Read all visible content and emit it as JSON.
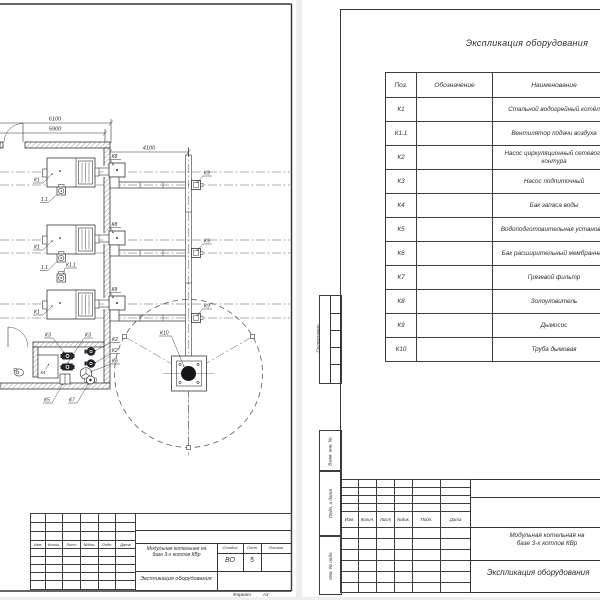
{
  "plan_sheet": {
    "dims": {
      "overall": "6100",
      "inner": "5900",
      "flue_offset": "4100"
    },
    "labels": {
      "boiler": "К1",
      "fan_short": "1.1",
      "fan": "К1.1",
      "pump_circ": "К2",
      "pump_feed": "К3",
      "tank": "К4",
      "water_unit": "К5",
      "exp_tank": "К6",
      "filter": "К7",
      "ash_catcher": "К8",
      "smoke_exhauster": "К9",
      "chimney": "К10"
    }
  },
  "equipment_table": {
    "title": "Экспликация оборудования",
    "headers": [
      "Поз.",
      "Обозначение",
      "Наименование"
    ],
    "rows": [
      {
        "pos": "К1",
        "name": "Стальной водогрейный котёл"
      },
      {
        "pos": "К1.1",
        "name": "Вентилятор подачи воздуха"
      },
      {
        "pos": "К2",
        "name": "Насос циркуляционный сетевого контура"
      },
      {
        "pos": "К3",
        "name": "Насос подпиточный"
      },
      {
        "pos": "К4",
        "name": "Бак запаса воды"
      },
      {
        "pos": "К5",
        "name": "Водоподготовительная установка"
      },
      {
        "pos": "К6",
        "name": "Бак расширительный мембранный"
      },
      {
        "pos": "К7",
        "name": "Грязевой фильтр"
      },
      {
        "pos": "К8",
        "name": "Золоуловитель"
      },
      {
        "pos": "К9",
        "name": "Дымосос"
      },
      {
        "pos": "К10",
        "name": "Труба дымовая"
      }
    ]
  },
  "stamp": {
    "rev_headers": [
      "Изм.",
      "Колич.",
      "Лист",
      "№док.",
      "Подп.",
      "Дата"
    ],
    "project_line1": "Модульная котельная на",
    "project_line2": "базе 3-х котлов КВр",
    "doc_title": "Экспликация оборудования",
    "stage_label": "Стадия",
    "sheet_label": "Лист",
    "sheets_label": "Листов",
    "stage": "ВО",
    "sheet_number": "5",
    "format_label": "Формат",
    "format_value": "А3",
    "side_labels": [
      "Согласовано",
      "Взам. инв. №",
      "Подп. и дата",
      "Инв. № подл."
    ]
  },
  "colors": {
    "paper": "#ffffff",
    "line": "#35363a",
    "background": "#eceef0"
  }
}
